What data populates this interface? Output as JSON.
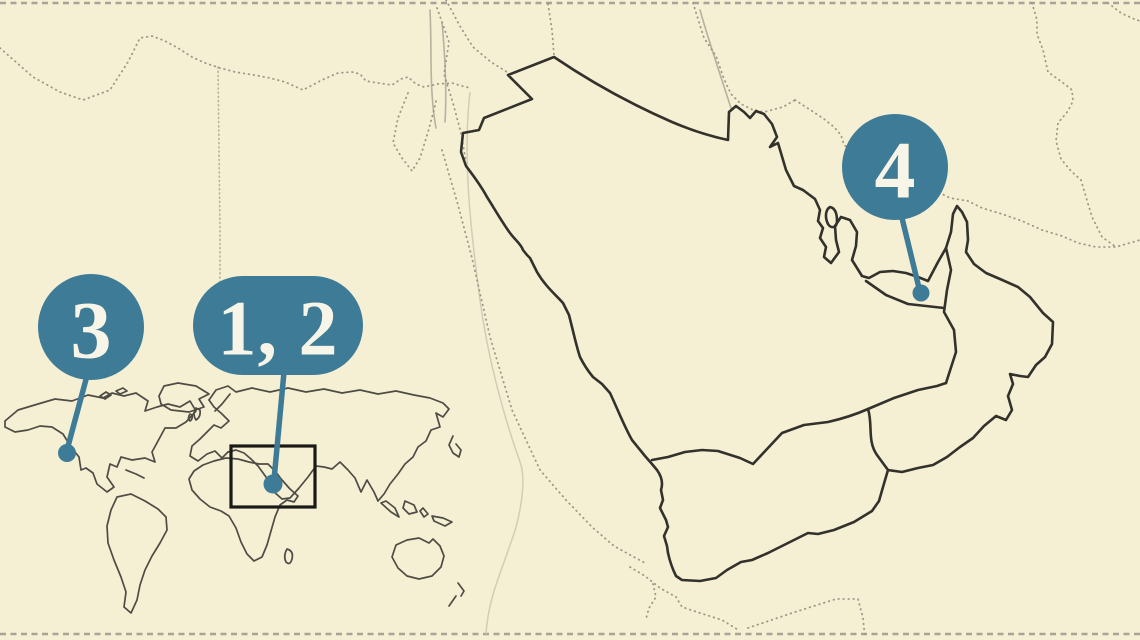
{
  "map": {
    "colors": {
      "background": "#f5efd4",
      "country_outline": "#33312b",
      "dotted_border": "#9d9889",
      "light_line": "#b7b19e",
      "river": "#cdc9b2",
      "world_outline": "#4e4c44",
      "highlight_rect": "#191915",
      "edge_dash": "#a8a394",
      "marker_fill": "#3e7b96",
      "marker_text": "#f7f4e8"
    },
    "markers": [
      {
        "label": "3"
      },
      {
        "label": "1, 2"
      },
      {
        "label": "4"
      }
    ]
  }
}
